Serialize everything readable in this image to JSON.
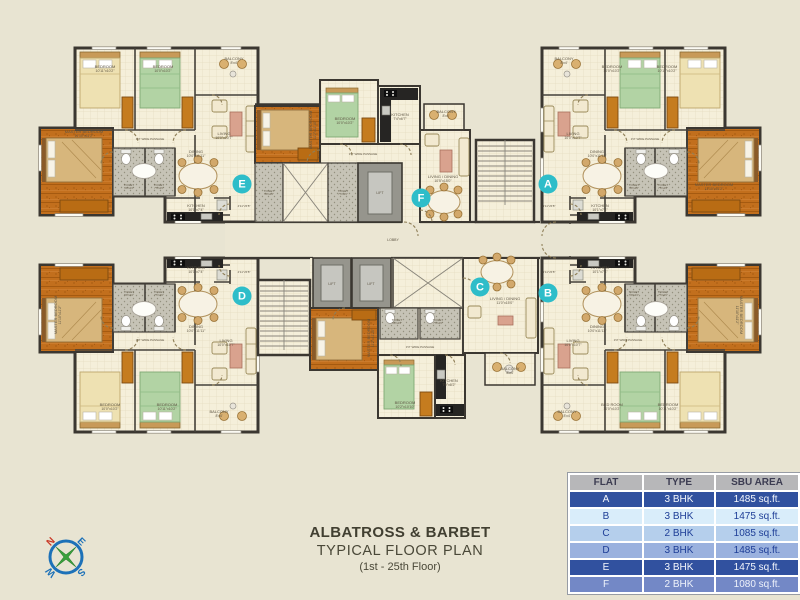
{
  "title": {
    "line1": "ALBATROSS & BARBET",
    "line2": "TYPICAL FLOOR PLAN",
    "line3": "(1st - 25th Floor)"
  },
  "compass": {
    "n": "N",
    "e": "E",
    "s": "S",
    "w": "W"
  },
  "table": {
    "headers": [
      "FLAT",
      "TYPE",
      "SBU AREA"
    ],
    "rows": [
      {
        "flat": "A",
        "type": "3 BHK",
        "area": "1485 sq.ft.",
        "style": "dark"
      },
      {
        "flat": "B",
        "type": "3 BHK",
        "area": "1475 sq.ft.",
        "style": "pale"
      },
      {
        "flat": "C",
        "type": "2 BHK",
        "area": "1085 sq.ft.",
        "style": "light"
      },
      {
        "flat": "D",
        "type": "3 BHK",
        "area": "1485 sq.ft.",
        "style": "mid"
      },
      {
        "flat": "E",
        "type": "3 BHK",
        "area": "1475 sq.ft.",
        "style": "dark"
      },
      {
        "flat": "F",
        "type": "2 BHK",
        "area": "1080 sq.ft.",
        "style": "medium"
      }
    ]
  },
  "plan": {
    "badge_color": "#2ebdc9",
    "badges": [
      {
        "l": "E",
        "x": 242,
        "y": 184
      },
      {
        "l": "F",
        "x": 421,
        "y": 198
      },
      {
        "l": "A",
        "x": 548,
        "y": 184
      },
      {
        "l": "D",
        "x": 242,
        "y": 296
      },
      {
        "l": "C",
        "x": 480,
        "y": 287
      },
      {
        "l": "B",
        "x": 548,
        "y": 293
      }
    ],
    "labels": [
      {
        "t": "BEDROOM",
        "d": "10'11\"x10'2\"",
        "x": 105,
        "y": 68
      },
      {
        "t": "BEDROOM",
        "d": "10'0\"x10'2\"",
        "x": 163,
        "y": 68
      },
      {
        "t": "BALCONY",
        "d": "8'x4'",
        "x": 234,
        "y": 60
      },
      {
        "t": "MASTER BEDROOM",
        "d": "11'10\"x11'2\"",
        "x": 84,
        "y": 133
      },
      {
        "t": "LIVING",
        "d": "10'0\"x10'7\"",
        "x": 224,
        "y": 135
      },
      {
        "t": "3'3\" WIDE PASSAGE",
        "x": 150,
        "y": 140,
        "s": 3
      },
      {
        "t": "DINING",
        "d": "10'0\"x11'11\"",
        "x": 196,
        "y": 153
      },
      {
        "t": "TOILET",
        "d": "5'8\"x4'2\"",
        "x": 129,
        "y": 186,
        "s": 3
      },
      {
        "t": "TOILET",
        "d": "7'5\"x4'0\"",
        "x": 159,
        "y": 186,
        "s": 3
      },
      {
        "t": "KITCHEN",
        "d": "10'1\"x7'4\"",
        "x": 196,
        "y": 207
      },
      {
        "t": "4'11\"x5'8\"",
        "x": 244,
        "y": 207,
        "s": 3
      },
      {
        "t": "MASTER BEDROOM",
        "d": "11'2\"x11'10\"",
        "x": 312,
        "y": 130,
        "r": -90
      },
      {
        "t": "BEDROOM",
        "d": "10'0\"x10'2\"",
        "x": 345,
        "y": 120
      },
      {
        "t": "KITCHEN",
        "d": "7'4\"x6'7\"",
        "x": 400,
        "y": 116
      },
      {
        "t": "BALCONY",
        "d": "8'x4'",
        "x": 446,
        "y": 113
      },
      {
        "t": "LIVING / DINING",
        "d": "10'5\"x15'0\"",
        "x": 443,
        "y": 178
      },
      {
        "t": "3'3\" WIDE PASSAGE",
        "x": 363,
        "y": 155,
        "s": 3
      },
      {
        "t": "TOILET",
        "d": "5'8\"x4'2\"",
        "x": 269,
        "y": 192,
        "s": 3
      },
      {
        "t": "TOILET",
        "d": "7'5\"x4'0\"",
        "x": 343,
        "y": 192,
        "s": 3
      },
      {
        "t": "LIFT",
        "x": 380,
        "y": 194,
        "s": 3.5
      },
      {
        "t": "BALCONY",
        "d": "8'x4'",
        "x": 564,
        "y": 60
      },
      {
        "t": "BEDROOM",
        "d": "10'0\"x10'2\"",
        "x": 612,
        "y": 68
      },
      {
        "t": "BEDROOM",
        "d": "10'11\"x10'2\"",
        "x": 667,
        "y": 68
      },
      {
        "t": "LIVING",
        "d": "10'0\"x10'7\"",
        "x": 573,
        "y": 135
      },
      {
        "t": "MASTER BEDROOM",
        "d": "11'10\"x11'2\"",
        "x": 714,
        "y": 186
      },
      {
        "t": "3'3\" WIDE PASSAGE",
        "x": 645,
        "y": 140,
        "s": 3
      },
      {
        "t": "DINING",
        "d": "10'0\"x11'11\"",
        "x": 597,
        "y": 153
      },
      {
        "t": "TOILET",
        "d": "5'8\"x4'2\"",
        "x": 634,
        "y": 186,
        "s": 3
      },
      {
        "t": "TOILET",
        "d": "7'5\"x4'0\"",
        "x": 663,
        "y": 186,
        "s": 3
      },
      {
        "t": "KITCHEN",
        "d": "10'1\"x7'4\"",
        "x": 600,
        "y": 207
      },
      {
        "t": "4'11\"x5'8\"",
        "x": 549,
        "y": 207,
        "s": 3
      },
      {
        "t": "LOBBY",
        "x": 393,
        "y": 241,
        "s": 3.5
      },
      {
        "t": "LIFT",
        "x": 332,
        "y": 285,
        "s": 3.5
      },
      {
        "t": "LIFT",
        "x": 371,
        "y": 285,
        "s": 3.5
      },
      {
        "t": "TOILET",
        "d": "5'8\"x4'2\"",
        "x": 397,
        "y": 321,
        "s": 3
      },
      {
        "t": "TOILET",
        "d": "7'5\"x4'0\"",
        "x": 438,
        "y": 321,
        "s": 3
      },
      {
        "t": "MASTER BEDROOM",
        "d": "11'2\"x11'10\"",
        "x": 370,
        "y": 338,
        "r": -90
      },
      {
        "t": "BEDROOM",
        "d": "10'2\"x10'10\"",
        "x": 405,
        "y": 404
      },
      {
        "t": "KITCHEN",
        "d": "7'9\"x8'2\"",
        "x": 449,
        "y": 382
      },
      {
        "t": "LIVING / DINING",
        "d": "11'0\"x15'0\"",
        "x": 505,
        "y": 300
      },
      {
        "t": "3'3\" WIDE PASSAGE",
        "x": 420,
        "y": 348,
        "s": 3
      },
      {
        "t": "BALCONY",
        "d": "8'x4'",
        "x": 510,
        "y": 370
      },
      {
        "t": "KITCHEN",
        "d": "10'1\"x7'4\"",
        "x": 196,
        "y": 269
      },
      {
        "t": "DINING",
        "d": "10'0\"x11'11\"",
        "x": 196,
        "y": 328
      },
      {
        "t": "TOILET",
        "d": "5'8\"x4'2\"",
        "x": 129,
        "y": 293,
        "s": 3
      },
      {
        "t": "TOILET",
        "d": "7'5\"x4'0\"",
        "x": 159,
        "y": 293,
        "s": 3
      },
      {
        "t": "MASTER BEDROOM",
        "d": "11'10\"x11'2\"",
        "x": 57,
        "y": 315,
        "r": -90
      },
      {
        "t": "LIVING",
        "d": "10'0\"x10'7\"",
        "x": 226,
        "y": 342
      },
      {
        "t": "3'3\" WIDE PASSAGE",
        "x": 150,
        "y": 341,
        "s": 3
      },
      {
        "t": "BEDROOM",
        "d": "10'0\"x10'2\"",
        "x": 110,
        "y": 406
      },
      {
        "t": "BEDROOM",
        "d": "10'11\"x10'2\"",
        "x": 167,
        "y": 406
      },
      {
        "t": "BALCONY",
        "d": "8'x4'",
        "x": 219,
        "y": 413
      },
      {
        "t": "4'11\"x5'8\"",
        "x": 244,
        "y": 273,
        "s": 3
      },
      {
        "t": "KITCHEN",
        "d": "10'1\"x7'4\"",
        "x": 600,
        "y": 269
      },
      {
        "t": "DINING",
        "d": "10'0\"x11'11\"",
        "x": 597,
        "y": 328
      },
      {
        "t": "TOILET",
        "d": "5'8\"x4'2\"",
        "x": 634,
        "y": 293,
        "s": 3
      },
      {
        "t": "TOILET",
        "d": "7'5\"x4'0\"",
        "x": 663,
        "y": 293,
        "s": 3
      },
      {
        "t": "MASTER BEDROOM",
        "d": "11'10\"x11'2\"",
        "x": 740,
        "y": 315,
        "r": 90
      },
      {
        "t": "LIVING",
        "d": "10'0\"x10'7\"",
        "x": 573,
        "y": 342
      },
      {
        "t": "3'3\" WIDE PASSAGE",
        "x": 628,
        "y": 341,
        "s": 3
      },
      {
        "t": "BED ROOM",
        "d": "10'0\"x10'2\"",
        "x": 612,
        "y": 406
      },
      {
        "t": "BEDROOM",
        "d": "10'11\"x10'2\"",
        "x": 668,
        "y": 406
      },
      {
        "t": "BALCONY",
        "d": "8'x4'",
        "x": 567,
        "y": 413
      },
      {
        "t": "4'11\"x5'8\"",
        "x": 549,
        "y": 273,
        "s": 3
      }
    ]
  }
}
